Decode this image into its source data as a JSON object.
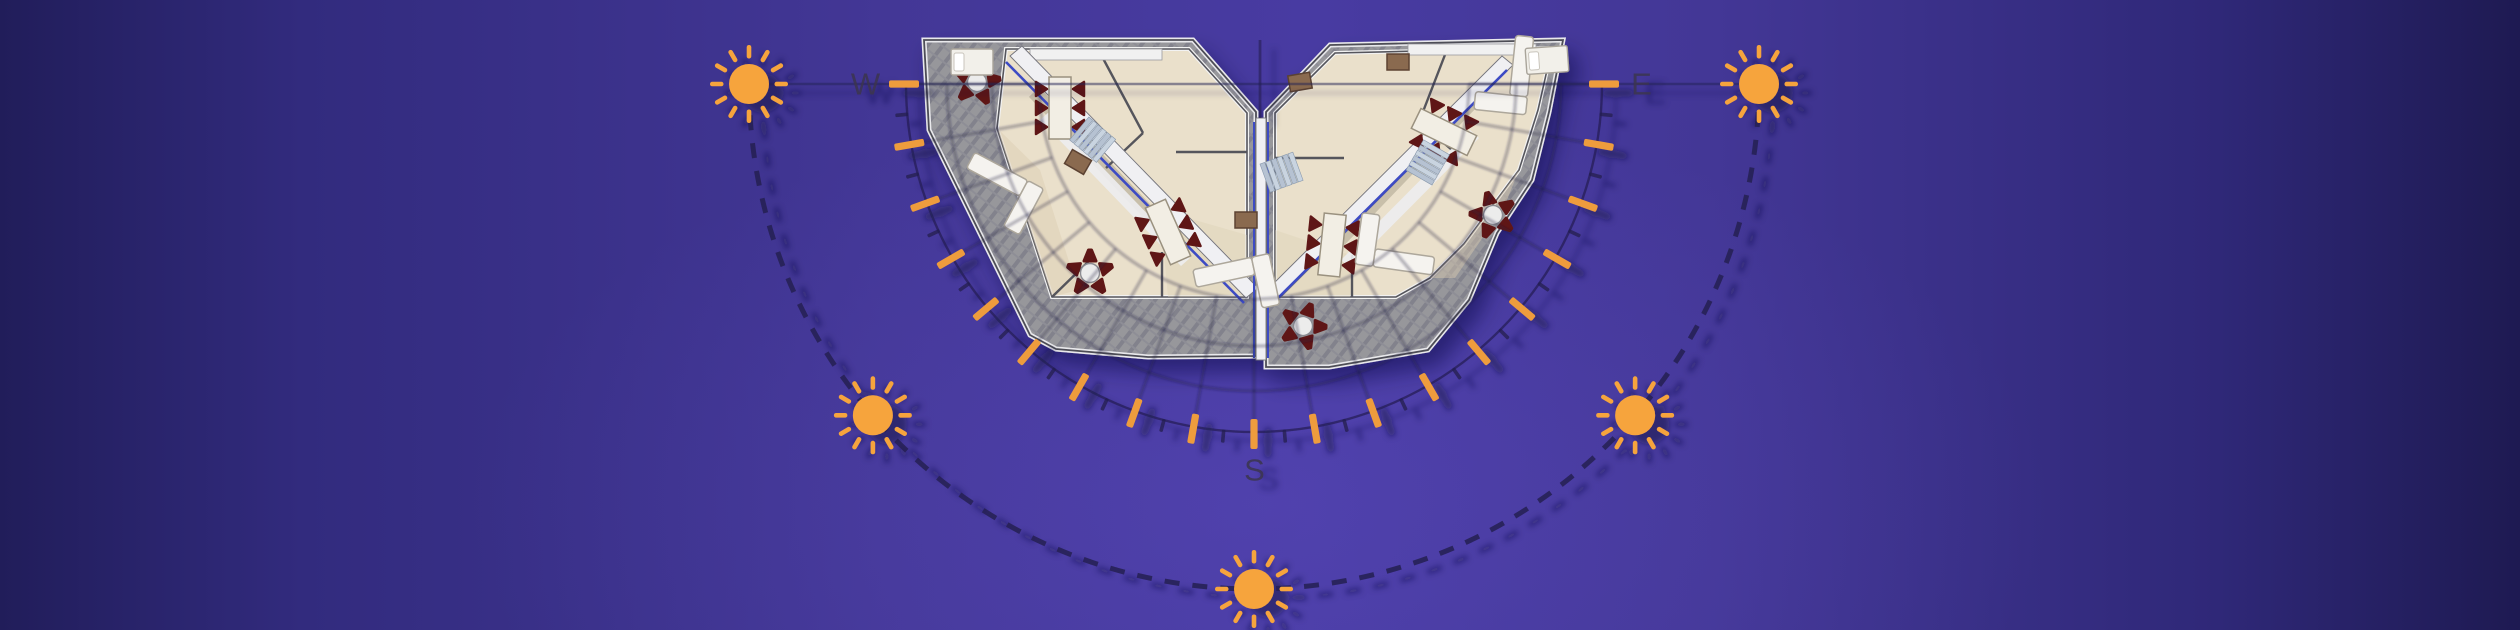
{
  "title": "Residential floor plan with sun path diagram",
  "compass": {
    "west": "W",
    "east": "E",
    "south": "S"
  },
  "diagram": {
    "center_x": 1254,
    "center_y": 84,
    "grid_radii": [
      215,
      262,
      307
    ],
    "tick_arc_radius": 348,
    "major_tick_step_deg": 10,
    "minor_tick_step_deg": 10,
    "major_tick_inner": 335,
    "major_tick_outer": 365,
    "minor_tick_inner": 347,
    "minor_tick_outer": 360,
    "radial_inner": 215,
    "radial_outer": 352,
    "label_radius": 388,
    "sun_path_radius": 505,
    "sun_angles_deg": [
      0,
      41,
      90,
      139,
      180
    ],
    "sun_body_radius": 20,
    "sun_ray_count": 12,
    "colors": {
      "sun": "#F6A43E",
      "tick_orange": "#EE9C3D",
      "line_dark": "#241E52",
      "grid_line": "#1A1440",
      "label": "#3C3550",
      "terrace_gray": "#97979B",
      "terrace_hatch": "#82828C",
      "wall_dark": "#54545C",
      "wall_white": "#F0F0F3",
      "floor_cream": "#EAE0CB",
      "floor_shade": "#DBCDB2",
      "chair_red": "#5E1616",
      "wood_brown": "#8A6A50",
      "accent_blue": "#3E4CC4",
      "stair_blue": "#B6C2D2"
    }
  },
  "furniture": [
    {
      "type": "patio-table",
      "x": 977,
      "y": 82,
      "rot": 10
    },
    {
      "type": "patio-table",
      "x": 1090,
      "y": 273,
      "rot": 0
    },
    {
      "type": "patio-table",
      "x": 1303,
      "y": 326,
      "rot": 20
    },
    {
      "type": "patio-table",
      "x": 1493,
      "y": 215,
      "rot": -15
    },
    {
      "type": "dining-table",
      "x": 1060,
      "y": 108,
      "rot": 0
    },
    {
      "type": "dining-table",
      "x": 1168,
      "y": 232,
      "rot": -24
    },
    {
      "type": "dining-table",
      "x": 1332,
      "y": 245,
      "rot": 6
    },
    {
      "type": "dining-table",
      "x": 1444,
      "y": 132,
      "rot": -64
    },
    {
      "type": "sofa-l",
      "x": 1002,
      "y": 178,
      "rot": 28
    },
    {
      "type": "sofa-l",
      "x": 1230,
      "y": 272,
      "rot": -12
    },
    {
      "type": "sofa-l",
      "x": 1398,
      "y": 260,
      "rot": 188
    },
    {
      "type": "sofa-l",
      "x": 1520,
      "y": 72,
      "rot": 96
    },
    {
      "type": "bed",
      "x": 972,
      "y": 62,
      "rot": 0
    },
    {
      "type": "bed",
      "x": 1547,
      "y": 60,
      "rot": -4
    },
    {
      "type": "wood-table",
      "x": 1078,
      "y": 162,
      "rot": 30
    },
    {
      "type": "wood-table",
      "x": 1246,
      "y": 220,
      "rot": 0
    },
    {
      "type": "wood-table",
      "x": 1300,
      "y": 82,
      "rot": -10
    },
    {
      "type": "wood-table",
      "x": 1398,
      "y": 62,
      "rot": 0
    },
    {
      "type": "stairs",
      "x": 1093,
      "y": 140,
      "rot": 40
    },
    {
      "type": "stairs",
      "x": 1282,
      "y": 172,
      "rot": -20
    },
    {
      "type": "stairs",
      "x": 1428,
      "y": 162,
      "rot": -60
    }
  ]
}
